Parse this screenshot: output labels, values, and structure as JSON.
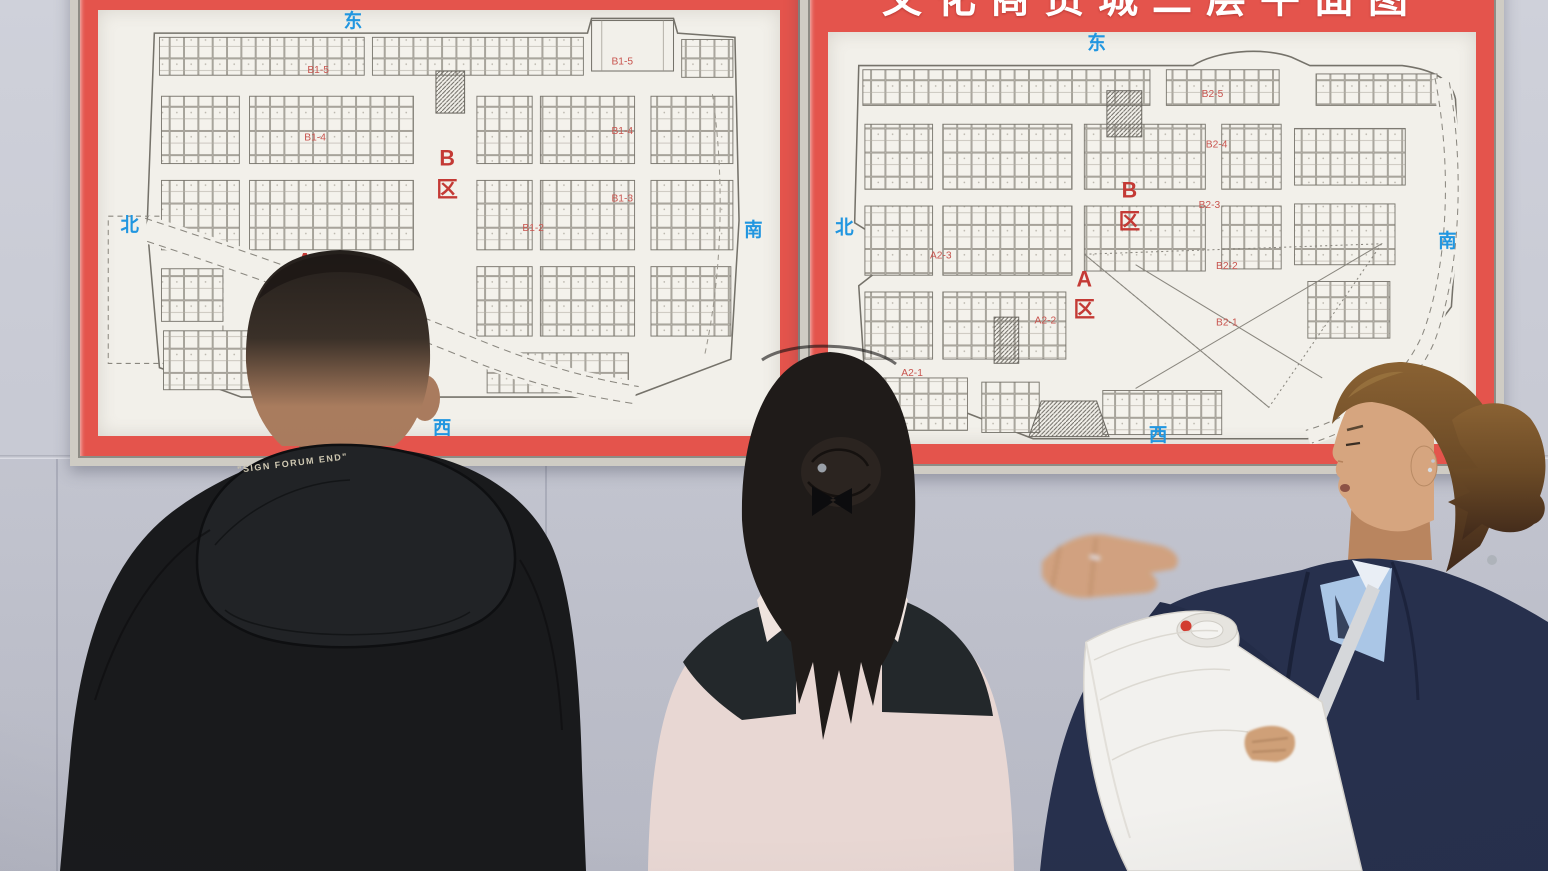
{
  "banner": {
    "title_partial": "文化商贸城二层平面图"
  },
  "floorplans": {
    "left": {
      "compass": {
        "east": "东",
        "south": "南",
        "west": "西",
        "north": "北"
      },
      "zone_b": "B",
      "zone_b_qu": "区",
      "zone_a": "A",
      "zone_a_qu": "区",
      "subs": [
        "B1-5",
        "B1-5",
        "B1-4",
        "B1-4",
        "B1-3",
        "B1-2",
        "A1-2",
        "A1-1"
      ]
    },
    "right": {
      "compass": {
        "east": "东",
        "south": "南",
        "west": "西",
        "north": "北"
      },
      "zone_b": "B",
      "zone_b_qu": "区",
      "zone_a": "A",
      "zone_a_qu": "区",
      "subs": [
        "B2-5",
        "B2-4",
        "B2-3",
        "B2-2",
        "B2-1",
        "A2-3",
        "A2-2",
        "A2-1"
      ]
    }
  },
  "people": {
    "man_hood_text": "\"SIGN FORUM END\""
  },
  "colors": {
    "poster_red": "#e4544c",
    "banner_red": "#d93a34",
    "compass_blue": "#2196e0",
    "zone_red": "#c43a35",
    "wall": "#c9cbd5",
    "paper": "#f2f0ea"
  }
}
